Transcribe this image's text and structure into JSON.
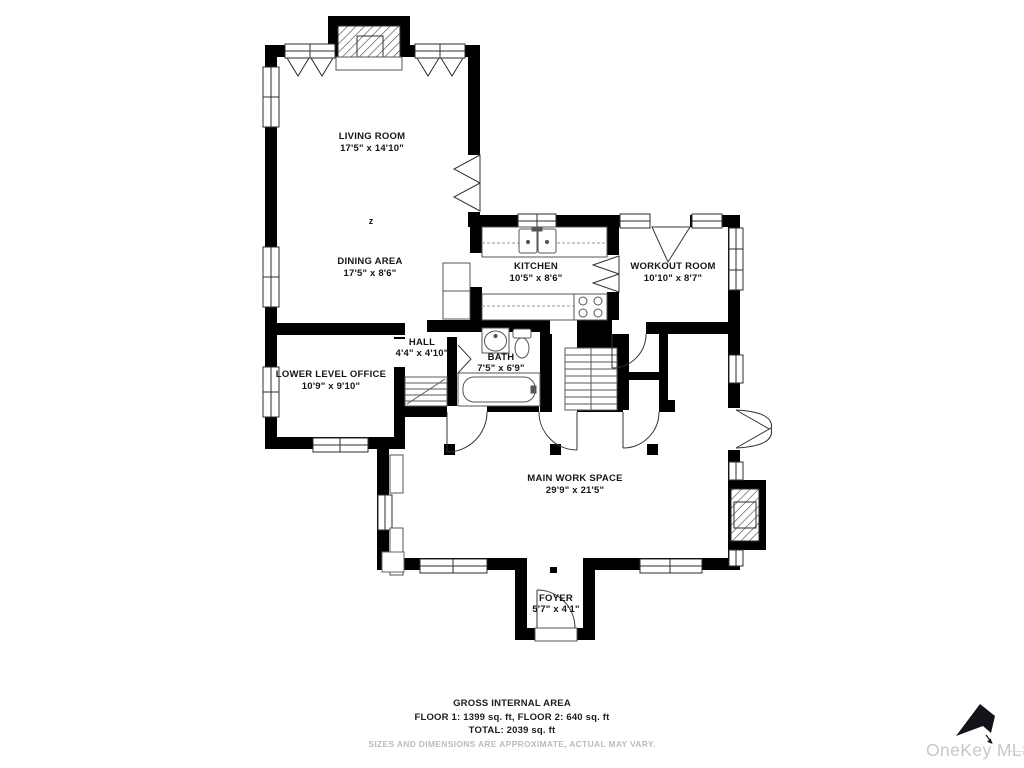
{
  "rooms": {
    "living": {
      "name": "LIVING ROOM",
      "dims": "17'5\" x 14'10\""
    },
    "dining": {
      "name": "DINING AREA",
      "dims": "17'5\" x 8'6\""
    },
    "kitchen": {
      "name": "KITCHEN",
      "dims": "10'5\" x 8'6\""
    },
    "workout": {
      "name": "WORKOUT ROOM",
      "dims": "10'10\" x 8'7\""
    },
    "hall": {
      "name": "HALL",
      "dims": "4'4\" x 4'10\""
    },
    "office": {
      "name": "LOWER LEVEL OFFICE",
      "dims": "10'9\" x 9'10\""
    },
    "bath": {
      "name": "BATH",
      "dims": "7'5\" x 6'9\""
    },
    "main": {
      "name": "MAIN WORK SPACE",
      "dims": "29'9\" x 21'5\""
    },
    "foyer": {
      "name": "FOYER",
      "dims": "5'7\" x 4'1\""
    }
  },
  "compass_mark": "z",
  "footer": {
    "gross_label": "GROSS INTERNAL AREA",
    "floors_line": "FLOOR 1: 1399 sq. ft, FLOOR 2: 640 sq. ft",
    "total_line": "TOTAL: 2039 sq. ft",
    "disclaimer": "SIZES AND DIMENSIONS ARE APPROXIMATE, ACTUAL MAY VARY."
  },
  "watermark": {
    "brand": "OneKey MLS"
  },
  "colors": {
    "walls": "#000000",
    "fixtures": "#555555",
    "label_text": "#161616",
    "disclaimer_text": "#bcbcbc",
    "watermark_text": "#c7c7c7",
    "watermark_arrow": "#13131b"
  }
}
